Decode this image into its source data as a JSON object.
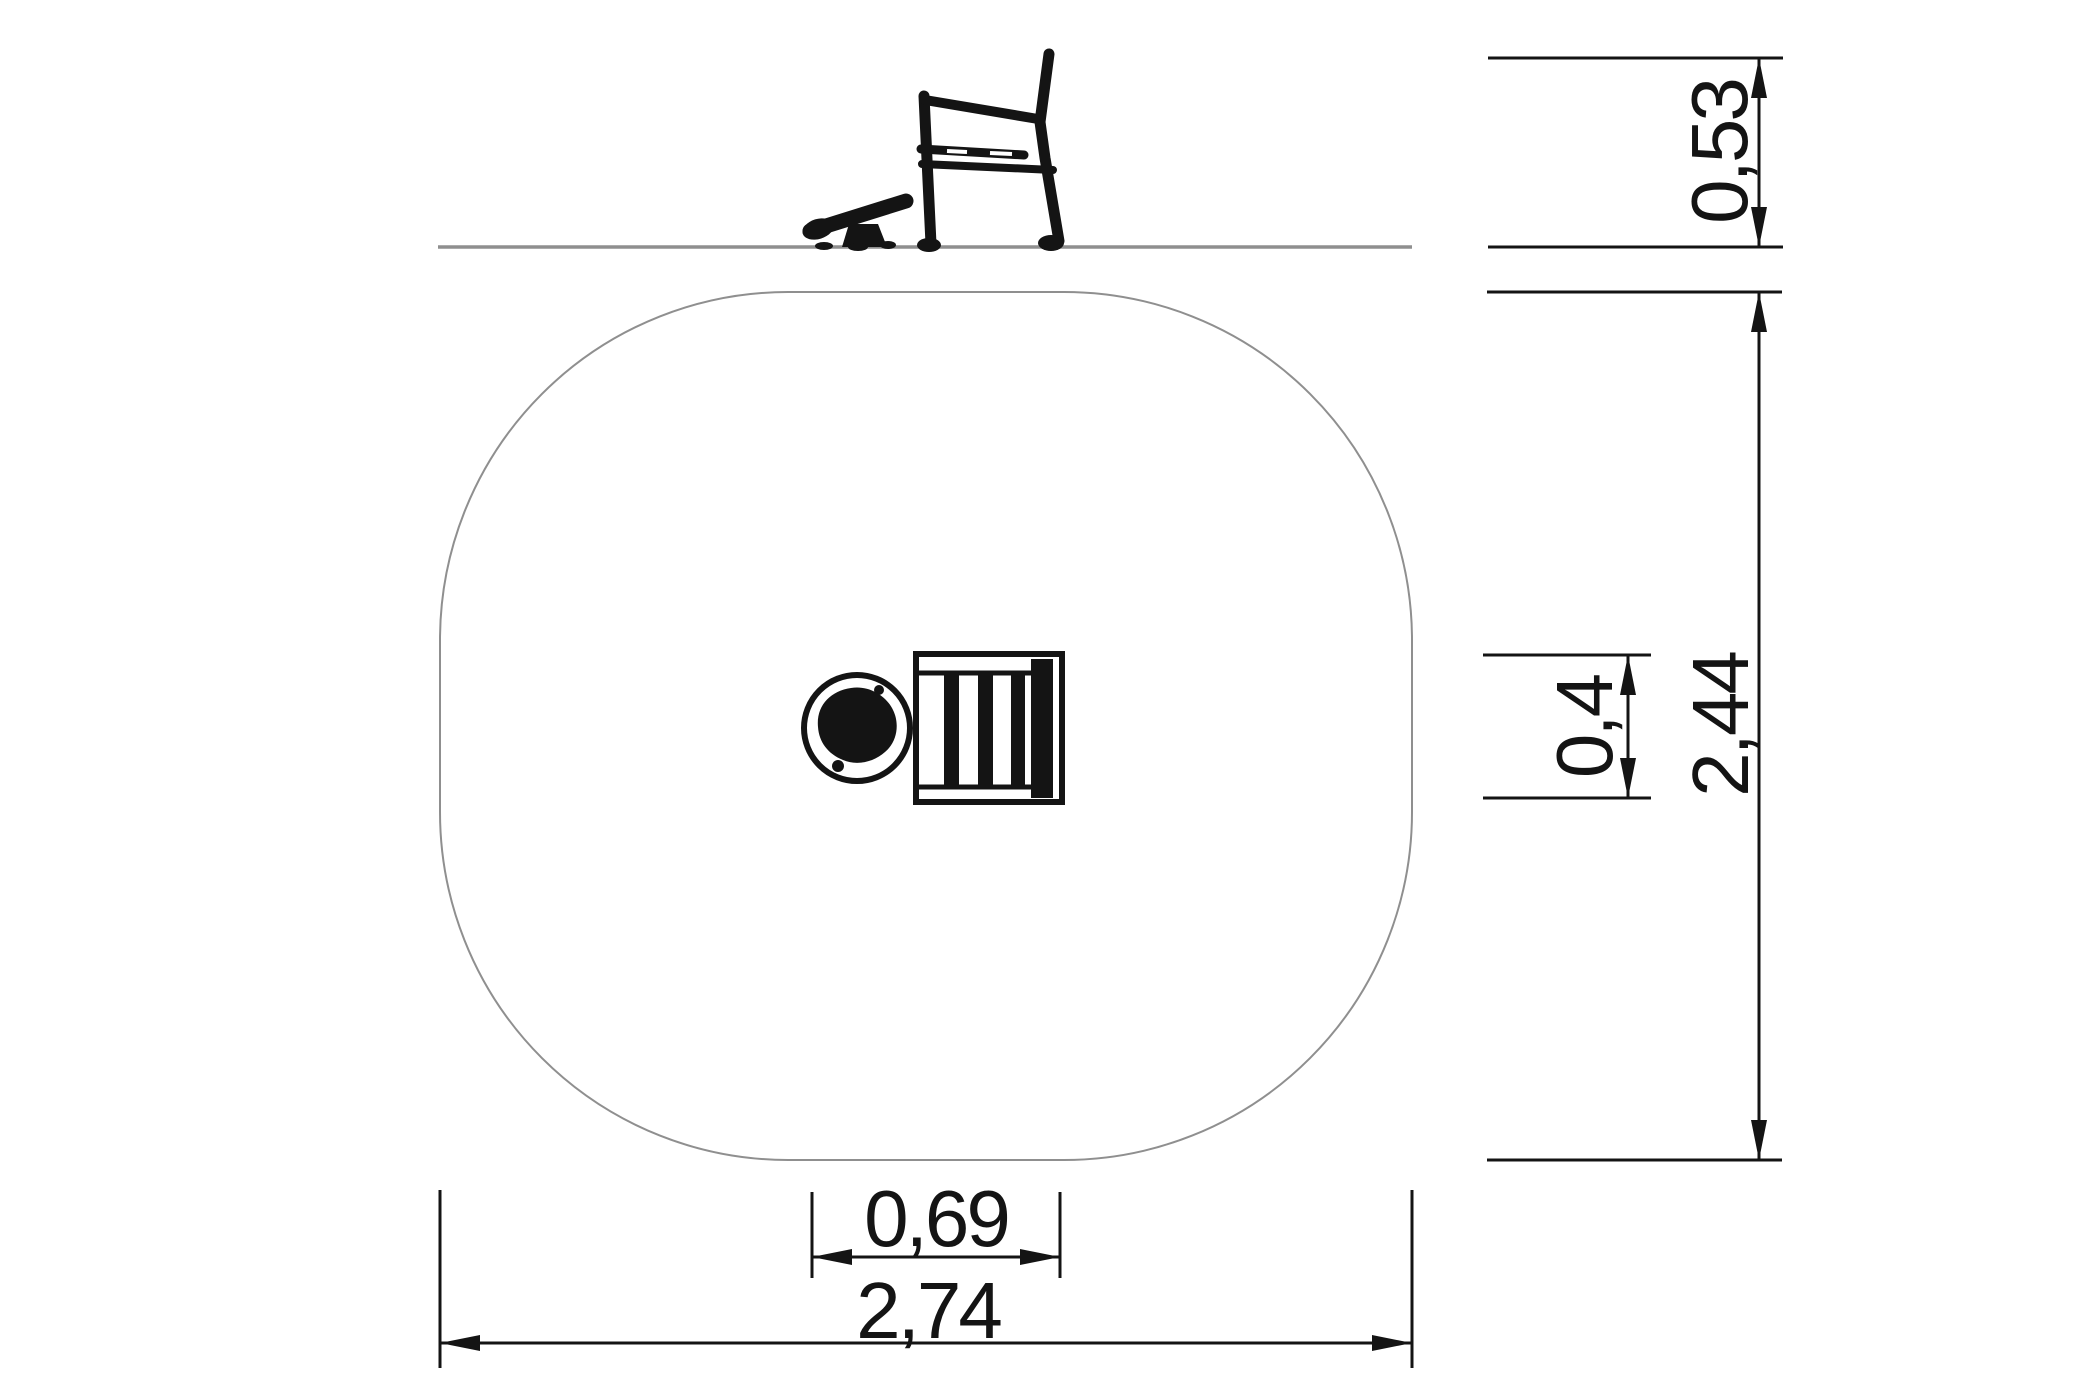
{
  "dimensions": {
    "seat_height_above_ground": "0,53",
    "safety_zone_depth": "2,44",
    "seat_depth": "0,4",
    "equipment_width": "0,69",
    "safety_zone_width": "2,74"
  },
  "colors": {
    "ink": "#141414",
    "construction": "#8f8f8f",
    "canvas": "#ffffff"
  }
}
